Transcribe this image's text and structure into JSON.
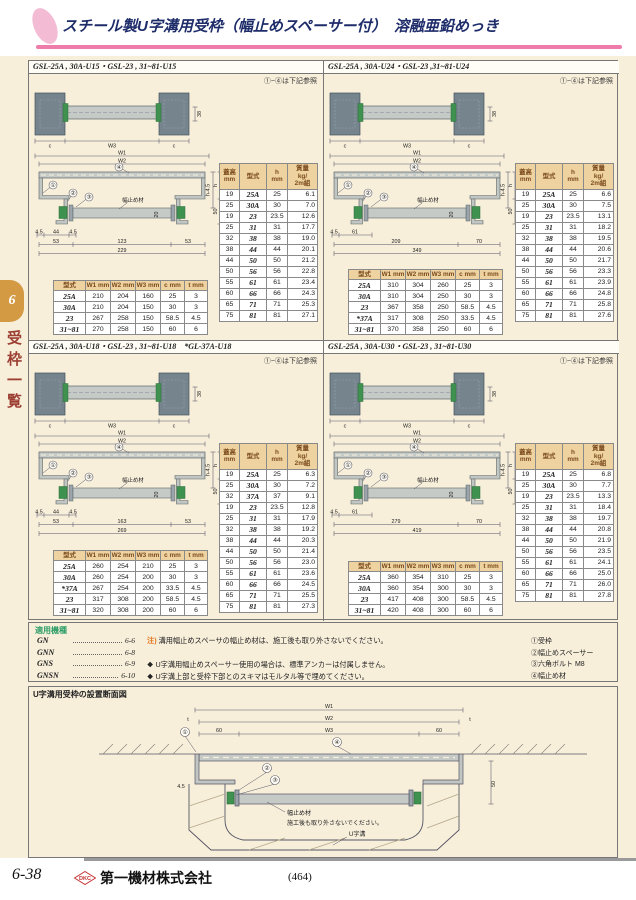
{
  "header": {
    "title": "スチール製U字溝用受枠（幅止めスペーサー付）　溶融亜鉛めっき"
  },
  "sidebar": {
    "tab": "6",
    "label": "受枠一覧"
  },
  "colors": {
    "accent_pink": "#ee7cab",
    "title_navy": "#1e2d6a",
    "table_header_bg": "#eed2a0",
    "table_header_text": "#7a4a1c",
    "tab_orange": "#d49a43",
    "sidebar_red": "#9c3f33",
    "apps_green": "#2f9e68",
    "note_orange": "#e0761e",
    "steel_dark": "#76848e",
    "steel_light": "#c6cac6",
    "bolt_green": "#3f9150",
    "logo_red": "#c53030"
  },
  "panels": [
    {
      "title": "GSL-25A , 30A-U15・GSL-23 , 31~81-U15",
      "ref_note": "①~④は下記参照",
      "drawing": {
        "top_view": {
          "dims": [
            "c",
            "W3",
            "c"
          ],
          "side_dim": "38"
        },
        "section": {
          "w1": "W1",
          "w2": "W2",
          "callout_frame": "①",
          "callout_spacer": "②",
          "callout_bolt": "③",
          "callout_plate": "④",
          "spacer_label": "幅止め材",
          "depth_dim": "20",
          "right_dims": [
            "h-4.5",
            "h",
            "50"
          ],
          "bottom_rows": [
            [
              "4.5",
              "44",
              "4.5"
            ],
            [
              "53",
              "123",
              "53"
            ],
            [
              "229"
            ]
          ]
        }
      },
      "spec_table": {
        "headers": [
          [
            "型式"
          ],
          [
            "W1 mm"
          ],
          [
            "W2 mm"
          ],
          [
            "W3 mm"
          ],
          [
            "c mm"
          ],
          [
            "t mm"
          ]
        ],
        "rows": [
          [
            "25A",
            "210",
            "204",
            "160",
            "25",
            "3"
          ],
          [
            "30A",
            "210",
            "204",
            "150",
            "30",
            "3"
          ],
          [
            "23",
            "267",
            "258",
            "150",
            "58.5",
            "4.5"
          ],
          [
            "31~81",
            "270",
            "258",
            "150",
            "60",
            "6"
          ]
        ]
      },
      "height_table": {
        "headers": [
          [
            "蓋高",
            "mm"
          ],
          [
            "型式"
          ],
          [
            "h",
            "mm"
          ],
          [
            "質量",
            "kg/",
            "2m組"
          ]
        ],
        "rows": [
          [
            "19",
            "25A",
            "25",
            "6.1"
          ],
          [
            "25",
            "30A",
            "30",
            "7.0"
          ],
          [
            "19",
            "23",
            "23.5",
            "12.6"
          ],
          [
            "25",
            "31",
            "31",
            "17.7"
          ],
          [
            "32",
            "38",
            "38",
            "19.0"
          ],
          [
            "38",
            "44",
            "44",
            "20.1"
          ],
          [
            "44",
            "50",
            "50",
            "21.2"
          ],
          [
            "50",
            "56",
            "56",
            "22.8"
          ],
          [
            "55",
            "61",
            "61",
            "23.4"
          ],
          [
            "60",
            "66",
            "66",
            "24.3"
          ],
          [
            "65",
            "71",
            "71",
            "25.3"
          ],
          [
            "75",
            "81",
            "81",
            "27.1"
          ]
        ]
      }
    },
    {
      "title": "GSL-25A , 30A-U24・GSL-23 ,31~81-U24",
      "ref_note": "①~④は下記参照",
      "drawing": {
        "top_view": {
          "dims": [
            "c",
            "W3",
            "c"
          ],
          "side_dim": "38"
        },
        "section": {
          "w1": "W1",
          "w2": "W2",
          "callout_frame": "①",
          "callout_spacer": "②",
          "callout_bolt": "③",
          "callout_plate": "④",
          "spacer_label": "幅止め材",
          "depth_dim": "20",
          "right_dims": [
            "h-4.5",
            "h",
            "50"
          ],
          "bottom_rows": [
            [
              "4.5",
              "61"
            ],
            [
              "209",
              "70"
            ],
            [
              "349"
            ]
          ]
        }
      },
      "spec_table": {
        "headers": [
          [
            "型式"
          ],
          [
            "W1 mm"
          ],
          [
            "W2 mm"
          ],
          [
            "W3 mm"
          ],
          [
            "c mm"
          ],
          [
            "t mm"
          ]
        ],
        "rows": [
          [
            "25A",
            "310",
            "304",
            "260",
            "25",
            "3"
          ],
          [
            "30A",
            "310",
            "304",
            "250",
            "30",
            "3"
          ],
          [
            "23",
            "367",
            "358",
            "250",
            "58.5",
            "4.5"
          ],
          [
            "*37A",
            "317",
            "308",
            "250",
            "33.5",
            "4.5"
          ],
          [
            "31~81",
            "370",
            "358",
            "250",
            "60",
            "6"
          ]
        ]
      },
      "height_table": {
        "headers": [
          [
            "蓋高",
            "mm"
          ],
          [
            "型式"
          ],
          [
            "h",
            "mm"
          ],
          [
            "質量",
            "kg/",
            "2m組"
          ]
        ],
        "rows": [
          [
            "19",
            "25A",
            "25",
            "6.6"
          ],
          [
            "25",
            "30A",
            "30",
            "7.5"
          ],
          [
            "19",
            "23",
            "23.5",
            "13.1"
          ],
          [
            "25",
            "31",
            "31",
            "18.2"
          ],
          [
            "32",
            "38",
            "38",
            "19.5"
          ],
          [
            "38",
            "44",
            "44",
            "20.6"
          ],
          [
            "44",
            "50",
            "50",
            "21.7"
          ],
          [
            "50",
            "56",
            "56",
            "23.3"
          ],
          [
            "55",
            "61",
            "61",
            "23.9"
          ],
          [
            "60",
            "66",
            "66",
            "24.8"
          ],
          [
            "65",
            "71",
            "71",
            "25.8"
          ],
          [
            "75",
            "81",
            "81",
            "27.6"
          ]
        ]
      }
    },
    {
      "title": "GSL-25A , 30A-U18・GSL-23 , 31~81-U18　*GL-37A-U18",
      "ref_note": "①~④は下記参照",
      "drawing": {
        "top_view": {
          "dims": [
            "c",
            "W3",
            "c"
          ],
          "side_dim": "38"
        },
        "section": {
          "w1": "W1",
          "w2": "W2",
          "callout_frame": "①",
          "callout_spacer": "②",
          "callout_bolt": "③",
          "callout_plate": "④",
          "spacer_label": "幅止め材",
          "depth_dim": "20",
          "right_dims": [
            "h-4.5",
            "h",
            "50"
          ],
          "bottom_rows": [
            [
              "4.5",
              "44",
              "4.5"
            ],
            [
              "53",
              "163",
              "53"
            ],
            [
              "269"
            ]
          ]
        }
      },
      "spec_table": {
        "headers": [
          [
            "型式"
          ],
          [
            "W1 mm"
          ],
          [
            "W2 mm"
          ],
          [
            "W3 mm"
          ],
          [
            "c mm"
          ],
          [
            "t mm"
          ]
        ],
        "rows": [
          [
            "25A",
            "260",
            "254",
            "210",
            "25",
            "3"
          ],
          [
            "30A",
            "260",
            "254",
            "200",
            "30",
            "3"
          ],
          [
            "*37A",
            "267",
            "254",
            "200",
            "33.5",
            "4.5"
          ],
          [
            "23",
            "317",
            "308",
            "200",
            "58.5",
            "4.5"
          ],
          [
            "31~81",
            "320",
            "308",
            "200",
            "60",
            "6"
          ]
        ]
      },
      "height_table": {
        "headers": [
          [
            "蓋高",
            "mm"
          ],
          [
            "型式"
          ],
          [
            "h",
            "mm"
          ],
          [
            "質量",
            "kg/",
            "2m組"
          ]
        ],
        "rows": [
          [
            "19",
            "25A",
            "25",
            "6.3"
          ],
          [
            "25",
            "30A",
            "30",
            "7.2"
          ],
          [
            "32",
            "37A",
            "37",
            "9.1"
          ],
          [
            "19",
            "23",
            "23.5",
            "12.8"
          ],
          [
            "25",
            "31",
            "31",
            "17.9"
          ],
          [
            "32",
            "38",
            "38",
            "19.2"
          ],
          [
            "38",
            "44",
            "44",
            "20.3"
          ],
          [
            "44",
            "50",
            "50",
            "21.4"
          ],
          [
            "50",
            "56",
            "56",
            "23.0"
          ],
          [
            "55",
            "61",
            "61",
            "23.6"
          ],
          [
            "60",
            "66",
            "66",
            "24.5"
          ],
          [
            "65",
            "71",
            "71",
            "25.5"
          ],
          [
            "75",
            "81",
            "81",
            "27.3"
          ]
        ]
      }
    },
    {
      "title": "GSL-25A , 30A-U30・GSL-23 , 31~81-U30",
      "ref_note": "①~④は下記参照",
      "drawing": {
        "top_view": {
          "dims": [
            "c",
            "W3",
            "c"
          ],
          "side_dim": "38"
        },
        "section": {
          "w1": "W1",
          "w2": "W2",
          "callout_frame": "①",
          "callout_spacer": "②",
          "callout_bolt": "③",
          "callout_plate": "④",
          "spacer_label": "幅止め材",
          "depth_dim": "20",
          "right_dims": [
            "h-4.5",
            "h",
            "50"
          ],
          "bottom_rows": [
            [
              "4.5",
              "61"
            ],
            [
              "279",
              "70"
            ],
            [
              "419"
            ]
          ]
        }
      },
      "spec_table": {
        "headers": [
          [
            "型式"
          ],
          [
            "W1 mm"
          ],
          [
            "W2 mm"
          ],
          [
            "W3 mm"
          ],
          [
            "c mm"
          ],
          [
            "t mm"
          ]
        ],
        "rows": [
          [
            "25A",
            "360",
            "354",
            "310",
            "25",
            "3"
          ],
          [
            "30A",
            "360",
            "354",
            "300",
            "30",
            "3"
          ],
          [
            "23",
            "417",
            "408",
            "300",
            "58.5",
            "4.5"
          ],
          [
            "31~81",
            "420",
            "408",
            "300",
            "60",
            "6"
          ]
        ]
      },
      "height_table": {
        "headers": [
          [
            "蓋高",
            "mm"
          ],
          [
            "型式"
          ],
          [
            "h",
            "mm"
          ],
          [
            "質量",
            "kg/",
            "2m組"
          ]
        ],
        "rows": [
          [
            "19",
            "25A",
            "25",
            "6.8"
          ],
          [
            "25",
            "30A",
            "30",
            "7.7"
          ],
          [
            "19",
            "23",
            "23.5",
            "13.3"
          ],
          [
            "25",
            "31",
            "31",
            "18.4"
          ],
          [
            "32",
            "38",
            "38",
            "19.7"
          ],
          [
            "38",
            "44",
            "44",
            "20.8"
          ],
          [
            "44",
            "50",
            "50",
            "21.9"
          ],
          [
            "50",
            "56",
            "56",
            "23.5"
          ],
          [
            "55",
            "61",
            "61",
            "24.1"
          ],
          [
            "60",
            "66",
            "66",
            "25.0"
          ],
          [
            "65",
            "71",
            "71",
            "26.0"
          ],
          [
            "75",
            "81",
            "81",
            "27.8"
          ]
        ]
      }
    }
  ],
  "applications": {
    "title": "適用機種",
    "items": [
      {
        "name": "GN",
        "page": "6-6"
      },
      {
        "name": "GNN",
        "page": "6-8"
      },
      {
        "name": "GNS",
        "page": "6-9"
      },
      {
        "name": "GNSN",
        "page": "6-10"
      }
    ],
    "notes": [
      {
        "mark": "注)",
        "text": "溝用幅止めスペーサの幅止め材は、施工後も取り外さないでください。"
      },
      {
        "mark": "❖",
        "text": "U字溝用幅止めスペーサー使用の場合は、標準アンカーは付属しません。"
      },
      {
        "mark": "❖",
        "text": "U字溝上部と受枠下部とのスキマはモルタル等で埋めてください。"
      }
    ],
    "legend": [
      "①受枠",
      "②幅止めスペーサー",
      "③六角ボルト M8",
      "④幅止め材"
    ]
  },
  "installation": {
    "title": "U字溝用受枠の設置断面図",
    "labels": {
      "w1": "W1",
      "w2": "W2",
      "w3": "W3",
      "left60": "60",
      "right60": "60",
      "t_left": "t",
      "t_right": "t",
      "d50": "50",
      "d45": "4.5",
      "d20": "20",
      "c1": "①",
      "c2": "②",
      "c3": "③",
      "c4": "④",
      "spacer": "幅止め材",
      "spacer_note": "施工後も取り外さないでください。",
      "channel": "U字溝"
    }
  },
  "footer": {
    "page_no": "6-38",
    "logo_text": "DKC",
    "company": "第一機材株式会社",
    "center_page": "(464)"
  }
}
